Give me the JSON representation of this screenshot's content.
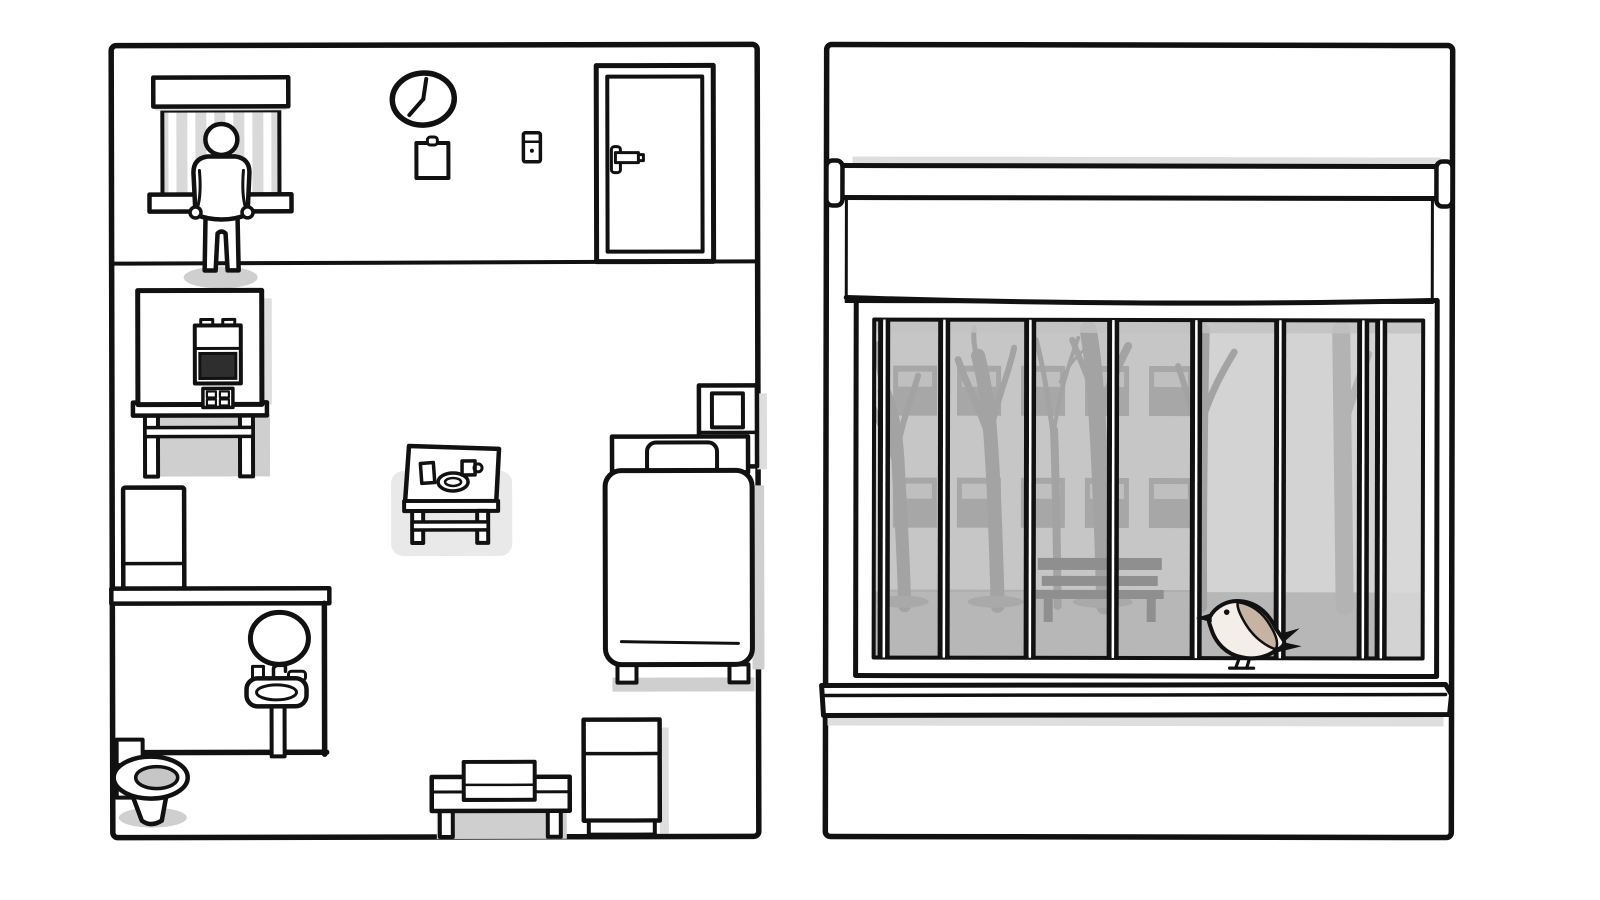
{
  "app": {
    "name": "hand-drawn room adventure scene",
    "style": "black outline cartoon, white fill, gray shading",
    "panels": [
      "room-overview",
      "barred-window-view"
    ]
  },
  "colors": {
    "outline": "#111111",
    "panel_fill": "#ffffff",
    "shadow": "#cfcfcf",
    "shadow_light": "#dedede",
    "slat_gray": "#d9d9d9",
    "screen_dark": "#2e2e2e",
    "water_gray": "#c6c6c6",
    "highlight_gray": "#e9e9e9",
    "sky": "#d3d3d3",
    "facade": "#c6c6c6",
    "facade_window": "#a7a7a7",
    "facade_pane": "#bfbfbf",
    "tree": "#a3a3a3",
    "tree_far": "#b3b3b3",
    "ground": "#b7b7b7",
    "ground_dark": "#a9a9a9",
    "bench_out": "#8f8f8f",
    "jamb_light": "#d8d8d8",
    "bird_body": "#f3efe8",
    "bird_wing": "#c7b3a2"
  },
  "room_panel": {
    "name": "patient room overview",
    "wall_items": [
      "window-with-blinds",
      "wall-clock",
      "clipboard",
      "light-switch",
      "door"
    ],
    "clock_time": "7:00",
    "person": {
      "pose": "standing",
      "location": "in front of barred window"
    },
    "floor_items": [
      "food-machine-on-table",
      "fridge",
      "bathroom",
      "tray-table",
      "bed",
      "nightstand",
      "towel-bench",
      "cabinet"
    ],
    "bathroom_items": [
      "mirror",
      "pedestal-sink",
      "toilet"
    ],
    "tray_items": [
      "glass",
      "plate",
      "cup"
    ]
  },
  "window_panel": {
    "name": "barred window view",
    "blind": {
      "state": "partially lowered"
    },
    "bars_count": 8,
    "outside": [
      "building-facade",
      "facade-windows",
      "bare-trees",
      "park-bench",
      "ground"
    ],
    "facade_window_rows": 2,
    "facade_window_cols": 5,
    "bird": {
      "species": "small songbird",
      "facing": "left",
      "perched_on": "window frame"
    }
  }
}
